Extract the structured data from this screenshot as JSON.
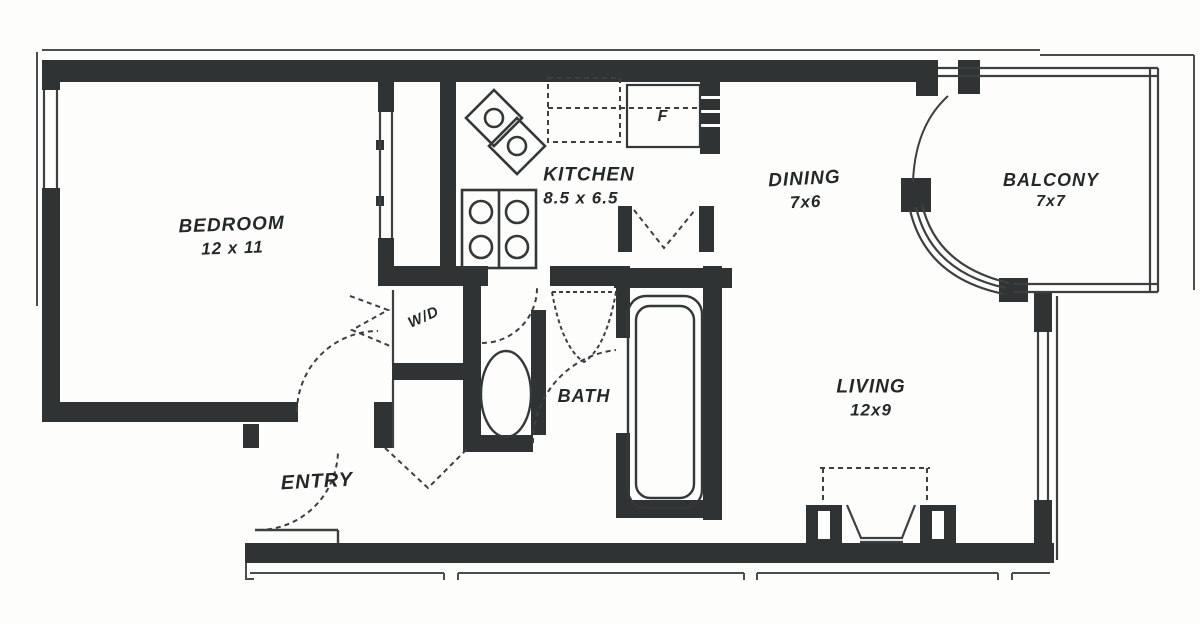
{
  "title": "Apartment floor plan",
  "rooms": {
    "bedroom": {
      "label": "BEDROOM",
      "dims": "12 x 11"
    },
    "kitchen": {
      "label": "KITCHEN",
      "dims": "8.5 x 6.5"
    },
    "dining": {
      "label": "DINING",
      "dims": "7x6"
    },
    "balcony": {
      "label": "BALCONY",
      "dims": "7x7"
    },
    "living": {
      "label": "LIVING",
      "dims": "12x9"
    },
    "bath": {
      "label": "BATH"
    },
    "entry": {
      "label": "ENTRY"
    },
    "laundry": {
      "label": "W/D"
    }
  },
  "fixtures": {
    "refrigerator": "F"
  },
  "colors": {
    "wall": "#2f3333",
    "line": "#3c4040",
    "background": "#fdfdfc",
    "text": "#232828"
  }
}
